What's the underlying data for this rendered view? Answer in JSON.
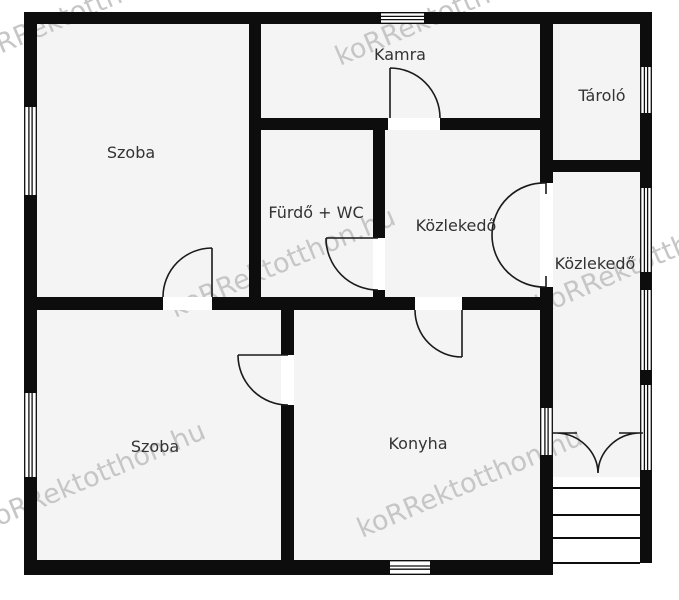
{
  "plan": {
    "title": "floor-plan",
    "rooms": [
      {
        "id": "szoba-1",
        "label": "Szoba"
      },
      {
        "id": "kamra",
        "label": "Kamra"
      },
      {
        "id": "tarolo",
        "label": "Tároló"
      },
      {
        "id": "furdo-wc",
        "label": "Fürdő + WC"
      },
      {
        "id": "kozlekedo-1",
        "label": "Közlekedő"
      },
      {
        "id": "kozlekedo-2",
        "label": "Közlekedő"
      },
      {
        "id": "szoba-2",
        "label": "Szoba"
      },
      {
        "id": "konyha",
        "label": "Konyha"
      }
    ],
    "watermark": {
      "text": "koRRektotthon.hu"
    },
    "stairs": {
      "step_lines": 4
    }
  },
  "colors": {
    "wall": "#0d0d0d",
    "room_fill": "#f4f4f4",
    "background": "#ffffff",
    "label_text": "#333333",
    "watermark": "#c6c6c6"
  }
}
